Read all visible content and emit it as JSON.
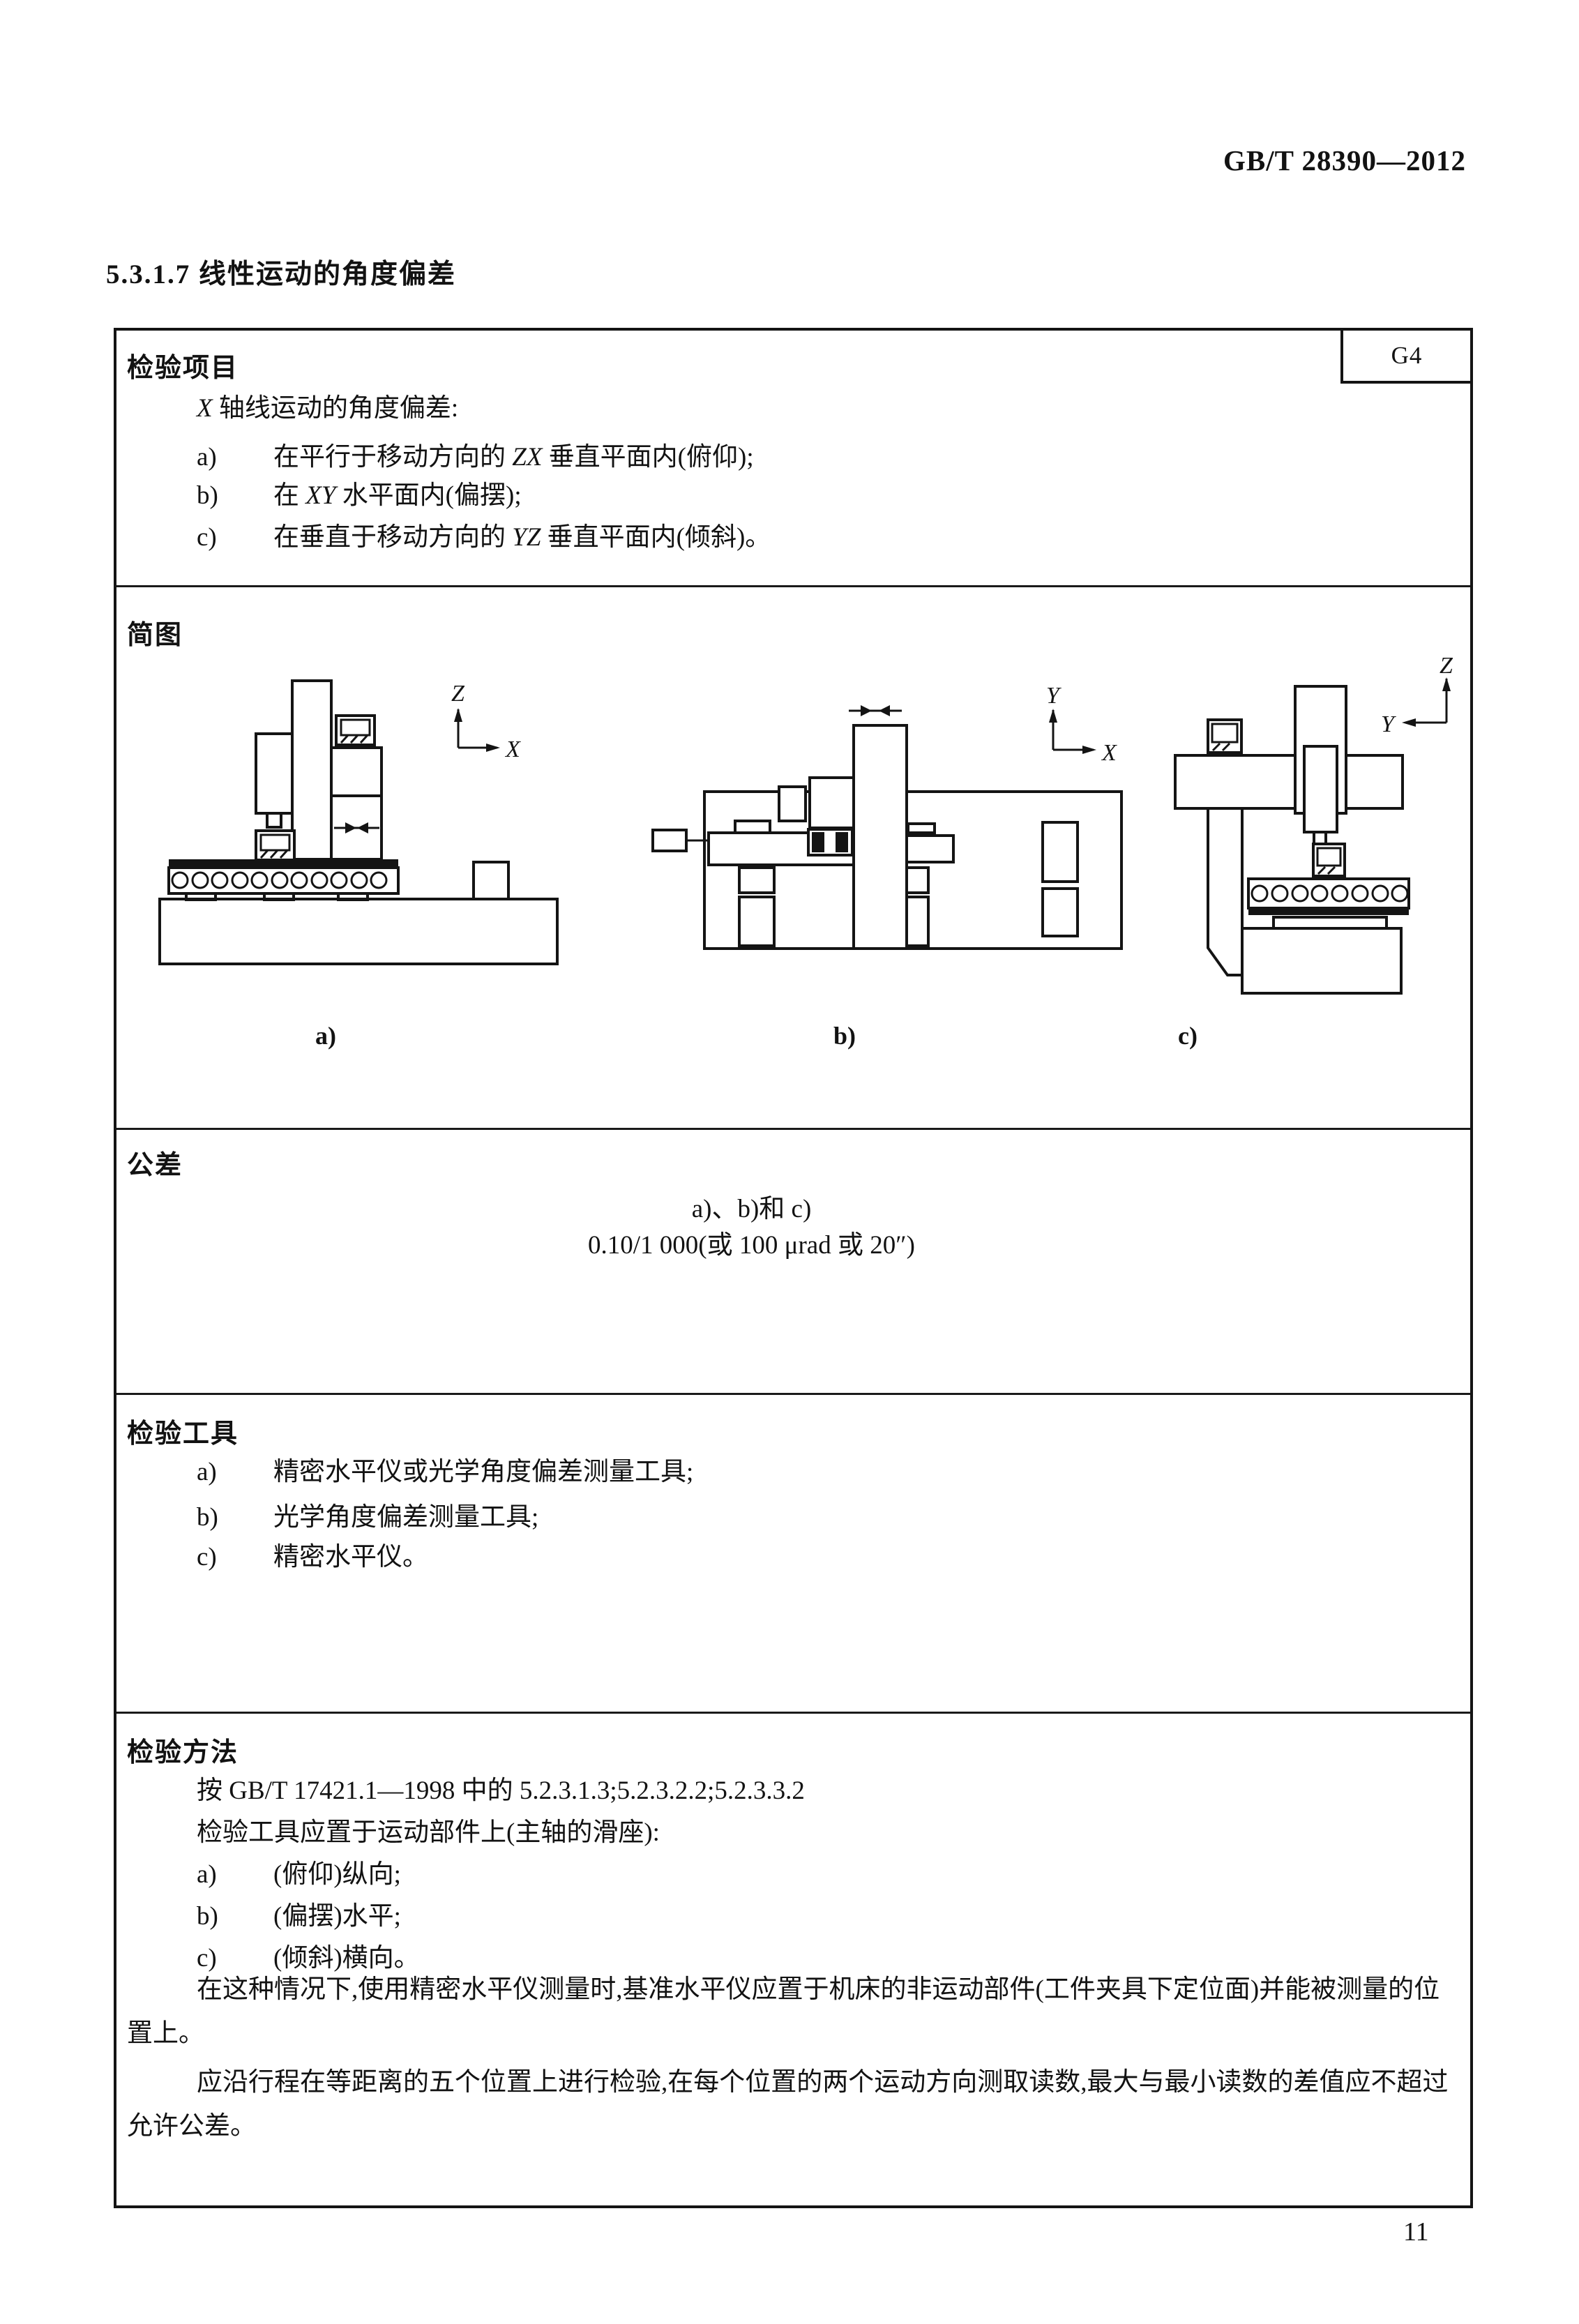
{
  "page": {
    "header": "GB/T 28390—2012",
    "section_title": "5.3.1.7  线性运动的角度偏差",
    "page_number": "11"
  },
  "table": {
    "item_label": "G4",
    "inspection_item": {
      "heading": "检验项目",
      "intro": {
        "axis": "X",
        "post": " 轴线运动的角度偏差:"
      },
      "items": [
        {
          "marker": "a)",
          "pre": "在平行于移动方向的 ",
          "axis": "ZX",
          "post": " 垂直平面内(俯仰);"
        },
        {
          "marker": "b)",
          "pre": "在 ",
          "axis": "XY",
          "post": " 水平面内(偏摆);"
        },
        {
          "marker": "c)",
          "pre": "在垂直于移动方向的 ",
          "axis": "YZ",
          "post": " 垂直平面内(倾斜)。"
        }
      ]
    },
    "diagram": {
      "heading": "简图",
      "captions": [
        "a)",
        "b)",
        "c)"
      ],
      "axes": {
        "a": {
          "v": "Z",
          "h": "X"
        },
        "b": {
          "v": "Y",
          "h": "X"
        },
        "c": {
          "v": "Z",
          "h": "Y"
        }
      }
    },
    "tolerance": {
      "heading": "公差",
      "scope": "a)、b)和 c)",
      "value": "0.10/1 000(或 100 μrad 或 20″)"
    },
    "inspection_tool": {
      "heading": "检验工具",
      "items": [
        {
          "marker": "a)",
          "text": "精密水平仪或光学角度偏差测量工具;"
        },
        {
          "marker": "b)",
          "text": "光学角度偏差测量工具;"
        },
        {
          "marker": "c)",
          "text": "精密水平仪。"
        }
      ]
    },
    "inspection_method": {
      "heading": "检验方法",
      "reference": "按 GB/T 17421.1—1998 中的 5.2.3.1.3;5.2.3.2.2;5.2.3.3.2",
      "setup": "检验工具应置于运动部件上(主轴的滑座):",
      "items": [
        {
          "marker": "a)",
          "text": "(俯仰)纵向;"
        },
        {
          "marker": "b)",
          "text": "(偏摆)水平;"
        },
        {
          "marker": "c)",
          "text": "(倾斜)横向。"
        }
      ],
      "para1": "在这种情况下,使用精密水平仪测量时,基准水平仪应置于机床的非运动部件(工件夹具下定位面)并能被测量的位置上。",
      "para2": "应沿行程在等距离的五个位置上进行检验,在每个位置的两个运动方向测取读数,最大与最小读数的差值应不超过允许公差。"
    }
  }
}
